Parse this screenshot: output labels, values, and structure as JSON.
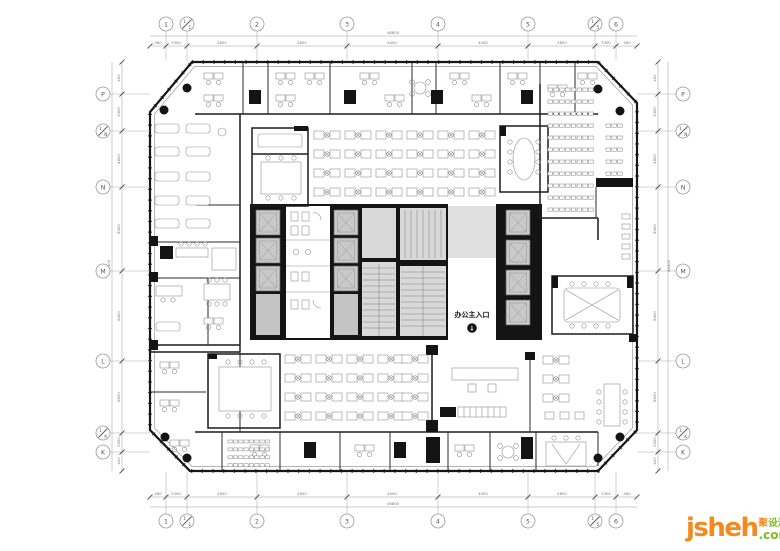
{
  "entrance": {
    "label": "办公主入口",
    "arrow": "↓"
  },
  "watermark": {
    "brand": "jsheh",
    "cn1": "聚",
    "cn2": "设汇",
    "tld": ".com",
    "orange": "#F5891D",
    "green": "#7DB928"
  },
  "grid": {
    "top": [
      {
        "a": "1"
      },
      {
        "a": "1",
        "b": "1"
      },
      {
        "a": "2"
      },
      {
        "a": "3"
      },
      {
        "a": "4"
      },
      {
        "a": "5"
      },
      {
        "a": "1",
        "b": "5"
      },
      {
        "a": "6"
      }
    ],
    "bottom": [
      {
        "a": "1"
      },
      {
        "a": "1",
        "b": "1"
      },
      {
        "a": "2"
      },
      {
        "a": "3"
      },
      {
        "a": "4"
      },
      {
        "a": "5"
      },
      {
        "a": "1",
        "b": "5"
      },
      {
        "a": "6"
      }
    ],
    "left": [
      {
        "a": "P"
      },
      {
        "a": "1",
        "b": "N"
      },
      {
        "a": "N"
      },
      {
        "a": "M"
      },
      {
        "a": "L"
      },
      {
        "a": "1",
        "b": "K"
      },
      {
        "a": "K"
      }
    ],
    "right": [
      {
        "a": "P"
      },
      {
        "a": "1",
        "b": "N"
      },
      {
        "a": "N"
      },
      {
        "a": "M"
      },
      {
        "a": "L"
      },
      {
        "a": "1",
        "b": "K"
      },
      {
        "a": "K"
      }
    ]
  },
  "dims": {
    "top": {
      "overall": "46800",
      "segs": [
        "460",
        "3300",
        "4850",
        "4850",
        "4000",
        "4000",
        "4850",
        "3300",
        "460"
      ]
    },
    "bottom": {
      "overall": "46800",
      "segs": [
        "460",
        "3300",
        "4850",
        "4850",
        "4000",
        "4000",
        "4850",
        "3300",
        "460"
      ]
    },
    "left": {
      "overall": "44400",
      "segs": [
        "400",
        "3300",
        "4800",
        "8400",
        "8400",
        "6600",
        "2000",
        "400"
      ]
    },
    "right": {
      "overall": "44400",
      "segs": [
        "400",
        "3300",
        "4800",
        "8400",
        "8400",
        "6600",
        "2000",
        "400"
      ]
    }
  }
}
